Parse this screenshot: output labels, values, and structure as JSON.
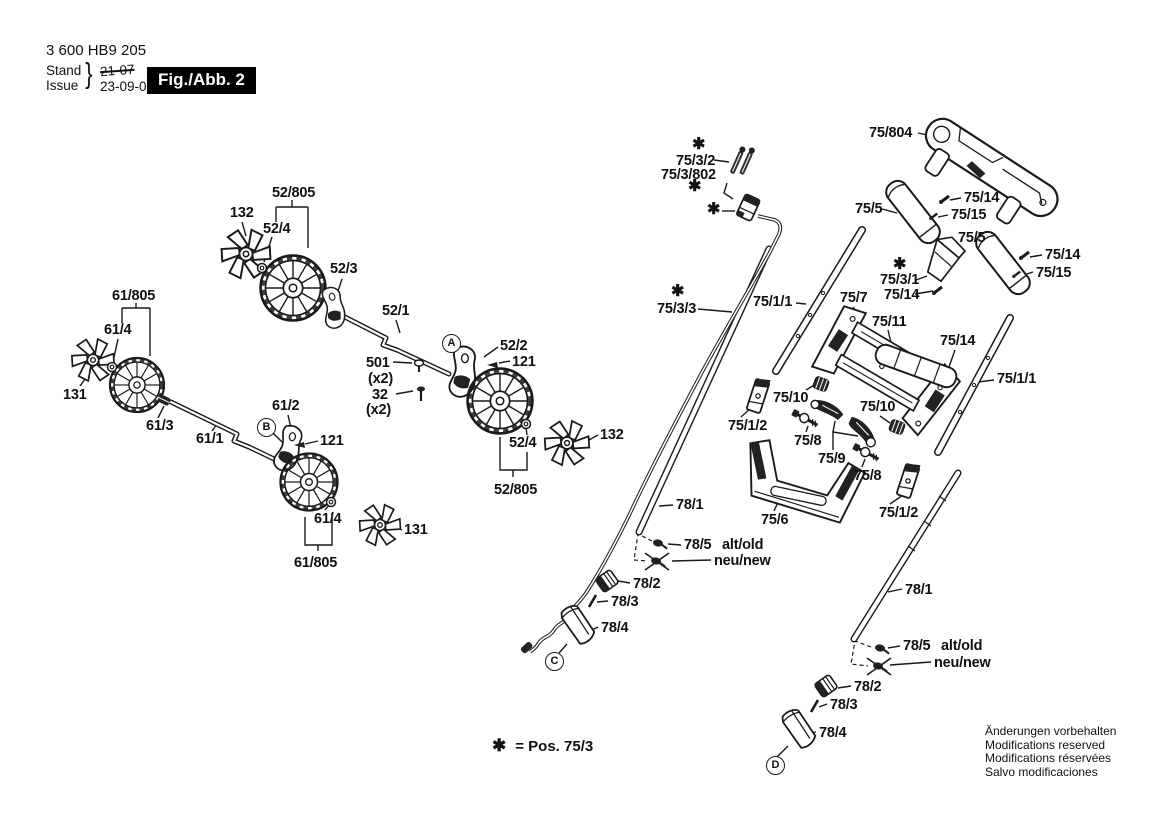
{
  "header": {
    "part_number": "3 600 HB9 205",
    "stand_label": "Stand",
    "issue_label": "Issue",
    "brace": "}",
    "stand_value": "21-07",
    "issue_value": "23-09-08",
    "figure_badge": "Fig./Abb. 2"
  },
  "footnote": {
    "symbol": "✱",
    "text": "= Pos. 75/3"
  },
  "legal_lines": [
    "Änderungen vorbehalten",
    "Modifications reserved",
    "Modifications réservées",
    "Salvo modificaciones"
  ],
  "markers": [
    {
      "id": "A",
      "x": 451,
      "y": 343
    },
    {
      "id": "B",
      "x": 266,
      "y": 427
    },
    {
      "id": "C",
      "x": 554,
      "y": 661
    },
    {
      "id": "D",
      "x": 775,
      "y": 765
    }
  ],
  "labels": [
    {
      "text": "52/805",
      "x": 272,
      "y": 186
    },
    {
      "text": "132",
      "x": 230,
      "y": 206
    },
    {
      "text": "52/4",
      "x": 263,
      "y": 222
    },
    {
      "text": "52/3",
      "x": 330,
      "y": 262
    },
    {
      "text": "52/1",
      "x": 382,
      "y": 304
    },
    {
      "text": "61/805",
      "x": 112,
      "y": 289
    },
    {
      "text": "61/4",
      "x": 104,
      "y": 323
    },
    {
      "text": "131",
      "x": 63,
      "y": 388
    },
    {
      "text": "61/3",
      "x": 146,
      "y": 419
    },
    {
      "text": "61/1",
      "x": 196,
      "y": 432
    },
    {
      "text": "61/2",
      "x": 272,
      "y": 399
    },
    {
      "text": "121",
      "x": 320,
      "y": 434
    },
    {
      "text": "61/4",
      "x": 314,
      "y": 512
    },
    {
      "text": "131",
      "x": 404,
      "y": 523
    },
    {
      "text": "61/805",
      "x": 294,
      "y": 556
    },
    {
      "text": "501",
      "x": 366,
      "y": 356
    },
    {
      "text": "(x2)",
      "x": 368,
      "y": 372
    },
    {
      "text": "32",
      "x": 372,
      "y": 388
    },
    {
      "text": "(x2)",
      "x": 366,
      "y": 403
    },
    {
      "text": "52/2",
      "x": 500,
      "y": 339
    },
    {
      "text": "121",
      "x": 512,
      "y": 355
    },
    {
      "text": "52/4",
      "x": 509,
      "y": 436
    },
    {
      "text": "132",
      "x": 600,
      "y": 428
    },
    {
      "text": "52/805",
      "x": 494,
      "y": 483
    },
    {
      "text": "✱",
      "x": 692,
      "y": 138,
      "cls": "star"
    },
    {
      "text": "75/3/2",
      "x": 676,
      "y": 154
    },
    {
      "text": "75/3/802",
      "x": 661,
      "y": 168
    },
    {
      "text": "✱",
      "x": 688,
      "y": 180,
      "cls": "star"
    },
    {
      "text": "✱",
      "x": 707,
      "y": 203,
      "cls": "star"
    },
    {
      "text": "75/804",
      "x": 869,
      "y": 126
    },
    {
      "text": "75/5",
      "x": 855,
      "y": 202
    },
    {
      "text": "75/14",
      "x": 964,
      "y": 191
    },
    {
      "text": "75/15",
      "x": 951,
      "y": 208
    },
    {
      "text": "75/5",
      "x": 958,
      "y": 231
    },
    {
      "text": "75/14",
      "x": 1045,
      "y": 248
    },
    {
      "text": "75/15",
      "x": 1036,
      "y": 266
    },
    {
      "text": "✱",
      "x": 893,
      "y": 258,
      "cls": "star"
    },
    {
      "text": "75/3/1",
      "x": 880,
      "y": 273
    },
    {
      "text": "75/14",
      "x": 884,
      "y": 288
    },
    {
      "text": "75/7",
      "x": 840,
      "y": 291
    },
    {
      "text": "✱",
      "x": 671,
      "y": 285,
      "cls": "star"
    },
    {
      "text": "75/3/3",
      "x": 657,
      "y": 302
    },
    {
      "text": "75/1/1",
      "x": 753,
      "y": 295
    },
    {
      "text": "75/11",
      "x": 872,
      "y": 315
    },
    {
      "text": "75/14",
      "x": 940,
      "y": 334
    },
    {
      "text": "75/1/1",
      "x": 997,
      "y": 372
    },
    {
      "text": "75/10",
      "x": 773,
      "y": 391
    },
    {
      "text": "75/10",
      "x": 860,
      "y": 400
    },
    {
      "text": "75/1/2",
      "x": 728,
      "y": 419
    },
    {
      "text": "75/8",
      "x": 794,
      "y": 434
    },
    {
      "text": "75/9",
      "x": 818,
      "y": 452
    },
    {
      "text": "75/8",
      "x": 854,
      "y": 469
    },
    {
      "text": "75/6",
      "x": 761,
      "y": 513
    },
    {
      "text": "75/1/2",
      "x": 879,
      "y": 506
    },
    {
      "text": "78/1",
      "x": 676,
      "y": 498
    },
    {
      "text": "78/5",
      "x": 684,
      "y": 538
    },
    {
      "text": "alt/old",
      "x": 722,
      "y": 538
    },
    {
      "text": "neu/new",
      "x": 714,
      "y": 554
    },
    {
      "text": "78/2",
      "x": 633,
      "y": 577
    },
    {
      "text": "78/3",
      "x": 611,
      "y": 595
    },
    {
      "text": "78/4",
      "x": 601,
      "y": 621
    },
    {
      "text": "78/1",
      "x": 905,
      "y": 583
    },
    {
      "text": "78/5",
      "x": 903,
      "y": 639
    },
    {
      "text": "alt/old",
      "x": 941,
      "y": 639
    },
    {
      "text": "neu/new",
      "x": 934,
      "y": 656
    },
    {
      "text": "78/2",
      "x": 854,
      "y": 680
    },
    {
      "text": "78/3",
      "x": 830,
      "y": 698
    },
    {
      "text": "78/4",
      "x": 819,
      "y": 726
    },
    {
      "text": "✱",
      "x": 492,
      "y": 735,
      "cls": "star hidden-probe"
    }
  ]
}
